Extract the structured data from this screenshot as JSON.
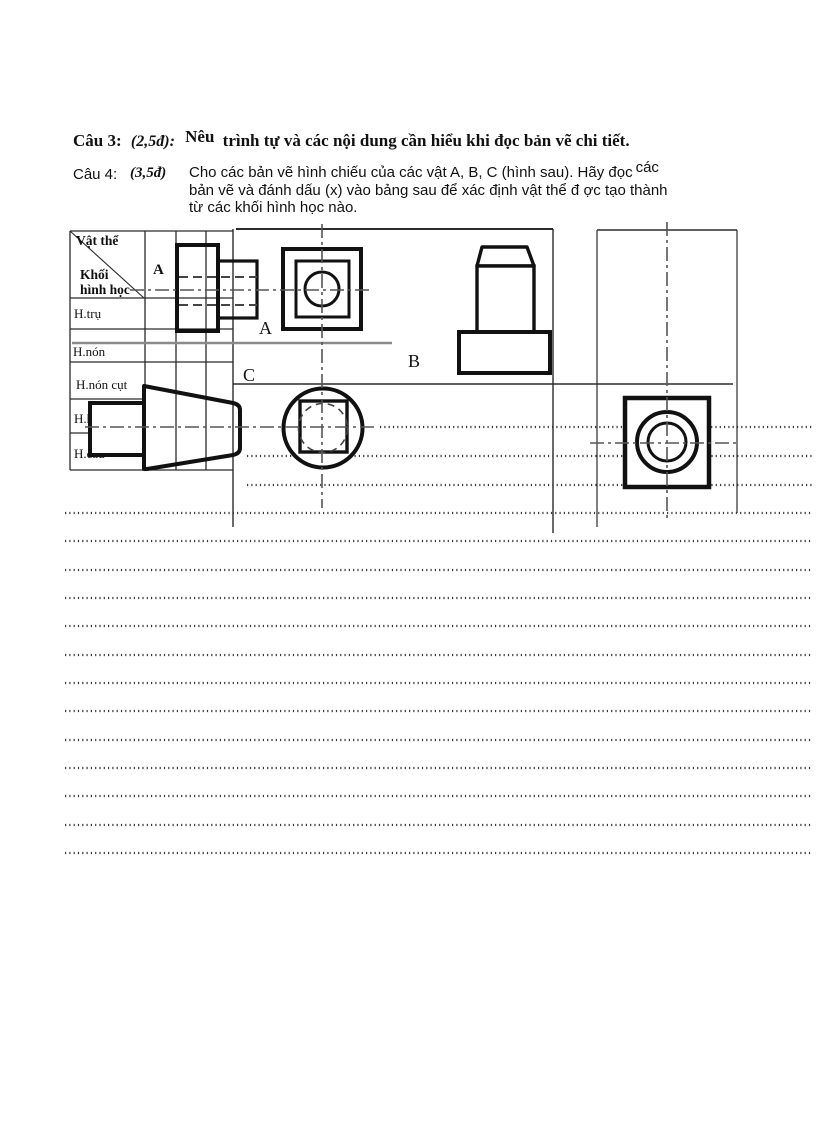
{
  "q3": {
    "label": "Câu 3:",
    "points": "(2,5đ):",
    "lead": "Nêu",
    "text": "trình tự và các nội dung cần hiểu khi đọc bản vẽ chi tiết."
  },
  "q4": {
    "label": "Câu 4:",
    "points": "(3,5đ)",
    "line1": "Cho các bản vẽ hình chiếu của các vật A, B, C (hình sau). Hãy đọc",
    "line1_sup": "các",
    "line2": "bản vẽ và đánh dấu (x) vào bảng sau để xác định vật thể đ ợc tạo thành",
    "line3": "từ các khối hình học nào."
  },
  "table": {
    "corner_object": "Vật thể",
    "corner_solid_1": "Khối",
    "corner_solid_2": "hình học",
    "column_a": "A",
    "rows": [
      "H.trụ",
      "H.nón",
      "H.nón cụt",
      "H.hộp",
      "H.cầu"
    ]
  },
  "figure_labels": {
    "a": "A",
    "b": "B",
    "c": "C"
  },
  "colors": {
    "line": "#1a1a1a",
    "thin_line": "#2b2b2b",
    "gray_divider": "#8a8a8a",
    "center_line": "#555555",
    "dots": "#3a3a3a"
  }
}
